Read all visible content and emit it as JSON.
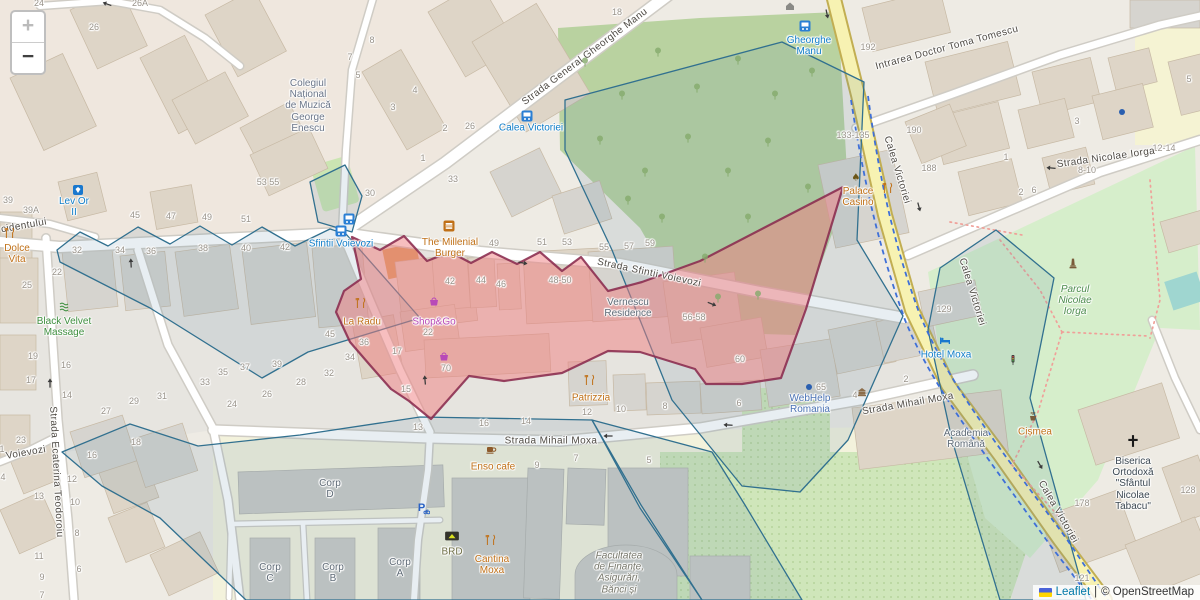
{
  "controls": {
    "zoom_in": "+",
    "zoom_out": "−"
  },
  "attribution": {
    "leaflet": "Leaflet",
    "separator": "|",
    "osm": "© OpenStreetMap"
  },
  "colors": {
    "selection_fill": "#ef7d80",
    "selection_stroke": "#8a2b4e",
    "district_stroke": "#31708f",
    "district_fill": "#5b8aa6",
    "primary_road": "#f7f2b2",
    "leaflet_link": "#0078a8",
    "park_green": "#d6eecb",
    "tree_green": "#b9d2a0",
    "campus_yellow": "#f3f2dc"
  },
  "map": {
    "street_labels": [
      [
        "Strada General Gheorghe Manu",
        585,
        57,
        -37
      ],
      [
        "Strada Sfintii Voievozi",
        649,
        273,
        12
      ],
      [
        "Strada Mihail Moxa",
        551,
        441,
        0
      ],
      [
        "Strada Mihail Moxa",
        908,
        404,
        -10
      ],
      [
        "Strada Nicolae Iorga",
        1106,
        158,
        -8
      ],
      [
        "Intrarea Doctor Toma Tomescu",
        947,
        48,
        -15
      ],
      [
        "Calea Victoriei",
        897,
        170,
        73
      ],
      [
        "Calea Victoriei",
        972,
        292,
        73
      ],
      [
        "Calea Victoriei",
        1058,
        512,
        60
      ],
      [
        "cidentului",
        24,
        226,
        -10
      ],
      [
        "Voievozi",
        26,
        453,
        -10
      ],
      [
        "Strada Ecaterina Teodoroiu",
        56,
        472,
        87
      ]
    ],
    "pois": [
      [
        "Colegiul\nNațional\nde Muzică\nGeorge\nEnescu",
        308,
        106,
        "school"
      ],
      [
        "Lev Or\nII",
        74,
        207,
        "blue"
      ],
      [
        "Dolce\nVita",
        17,
        254,
        "food"
      ],
      [
        "Black Velvet\nMassage",
        64,
        327,
        "green"
      ],
      [
        "Sfintii Voievozi",
        341,
        244,
        "blue"
      ],
      [
        "Calea Victoriei",
        531,
        128,
        "blue"
      ],
      [
        "Gheorghe\nManu",
        809,
        46,
        "blue"
      ],
      [
        "The Millenial\nBurger",
        450,
        248,
        "food"
      ],
      [
        "La Radu",
        362,
        322,
        "food"
      ],
      [
        "Shop&Go",
        434,
        322,
        "shop"
      ],
      [
        "Vernescu\nResidence",
        628,
        308,
        "muted"
      ],
      [
        "Palace\nCasino",
        858,
        197,
        "food"
      ],
      [
        "Patrizzia",
        591,
        398,
        "food"
      ],
      [
        "WebHelp\nRomania",
        810,
        404,
        "office"
      ],
      [
        "Hotel Moxa",
        946,
        355,
        "blue"
      ],
      [
        "Academia\nRomână",
        966,
        439,
        "muted"
      ],
      [
        "Cișmea",
        1035,
        432,
        "food"
      ],
      [
        "Biserica\nOrtodoxă\n\"Sfântul\nNicolae\nTabacu\"",
        1133,
        484,
        "church"
      ],
      [
        "Parcul\nNicolae\nIorga",
        1075,
        301,
        "park"
      ],
      [
        "Enso cafe",
        493,
        467,
        "food"
      ],
      [
        "BRD",
        452,
        552,
        "bank"
      ],
      [
        "Cantina\nMoxa",
        492,
        565,
        "food"
      ],
      [
        "Corp\nD",
        330,
        489,
        "muted"
      ],
      [
        "Corp\nC",
        270,
        573,
        "muted"
      ],
      [
        "Corp\nB",
        333,
        573,
        "muted"
      ],
      [
        "Corp\nA",
        400,
        568,
        "muted"
      ],
      [
        "Facultatea\nde Finanțe,\nAsigurări,\nBănci și",
        619,
        573,
        "mutedi"
      ]
    ],
    "house_numbers": [
      [
        "24",
        39,
        3
      ],
      [
        "26",
        94,
        27
      ],
      [
        "26A",
        140,
        3
      ],
      [
        "8",
        372,
        40
      ],
      [
        "7",
        350,
        57
      ],
      [
        "5",
        358,
        75
      ],
      [
        "3",
        393,
        107
      ],
      [
        "18",
        617,
        12
      ],
      [
        "4",
        415,
        90
      ],
      [
        "2",
        445,
        128
      ],
      [
        "26",
        470,
        126
      ],
      [
        "1",
        423,
        158
      ],
      [
        "33",
        453,
        179
      ],
      [
        "30",
        370,
        193
      ],
      [
        "53 55",
        268,
        182
      ],
      [
        "39",
        8,
        200
      ],
      [
        "39A",
        31,
        210
      ],
      [
        "45",
        135,
        215
      ],
      [
        "47",
        171,
        216
      ],
      [
        "49",
        207,
        217
      ],
      [
        "51",
        246,
        219
      ],
      [
        "32",
        77,
        250
      ],
      [
        "34",
        120,
        250
      ],
      [
        "36",
        151,
        251
      ],
      [
        "38",
        203,
        248
      ],
      [
        "40",
        246,
        248
      ],
      [
        "42",
        285,
        247
      ],
      [
        "22",
        57,
        272
      ],
      [
        "25",
        27,
        285
      ],
      [
        "19",
        33,
        356
      ],
      [
        "16",
        66,
        365
      ],
      [
        "17",
        31,
        380
      ],
      [
        "14",
        67,
        395
      ],
      [
        "49",
        494,
        243
      ],
      [
        "51",
        542,
        242
      ],
      [
        "53",
        567,
        242
      ],
      [
        "55",
        604,
        247
      ],
      [
        "57",
        629,
        246
      ],
      [
        "59",
        650,
        243
      ],
      [
        "42",
        450,
        281
      ],
      [
        "44",
        481,
        280
      ],
      [
        "46",
        501,
        284
      ],
      [
        "48-50",
        560,
        280
      ],
      [
        "56-58",
        694,
        317
      ],
      [
        "60",
        740,
        359
      ],
      [
        "36",
        364,
        342
      ],
      [
        "34",
        350,
        357
      ],
      [
        "22",
        428,
        332
      ],
      [
        "17",
        397,
        351
      ],
      [
        "15",
        406,
        389
      ],
      [
        "70",
        446,
        368
      ],
      [
        "13",
        418,
        427
      ],
      [
        "16",
        484,
        423
      ],
      [
        "14",
        526,
        421
      ],
      [
        "45",
        330,
        334
      ],
      [
        "39",
        277,
        364
      ],
      [
        "37",
        245,
        367
      ],
      [
        "35",
        223,
        372
      ],
      [
        "33",
        205,
        382
      ],
      [
        "31",
        162,
        396
      ],
      [
        "29",
        134,
        401
      ],
      [
        "27",
        106,
        411
      ],
      [
        "24",
        232,
        404
      ],
      [
        "26",
        267,
        394
      ],
      [
        "28",
        301,
        382
      ],
      [
        "32",
        329,
        373
      ],
      [
        "23",
        21,
        440
      ],
      [
        "1",
        2,
        449
      ],
      [
        "4",
        3,
        477
      ],
      [
        "16",
        92,
        455
      ],
      [
        "18",
        136,
        442
      ],
      [
        "12",
        72,
        479
      ],
      [
        "13",
        39,
        496
      ],
      [
        "10",
        75,
        502
      ],
      [
        "8",
        77,
        533
      ],
      [
        "11",
        39,
        556
      ],
      [
        "6",
        79,
        569
      ],
      [
        "9",
        42,
        577
      ],
      [
        "7",
        42,
        595
      ],
      [
        "9",
        537,
        465
      ],
      [
        "7",
        576,
        458
      ],
      [
        "5",
        649,
        460
      ],
      [
        "12",
        587,
        412
      ],
      [
        "10",
        621,
        409
      ],
      [
        "8",
        665,
        406
      ],
      [
        "6",
        739,
        403
      ],
      [
        "4",
        855,
        395
      ],
      [
        "2",
        906,
        379
      ],
      [
        "192",
        868,
        47
      ],
      [
        "190",
        914,
        130
      ],
      [
        "188",
        929,
        168
      ],
      [
        "133-135",
        853,
        135
      ],
      [
        "1",
        1006,
        157
      ],
      [
        "3",
        1077,
        121
      ],
      [
        "5",
        1189,
        79
      ],
      [
        "2",
        1021,
        192
      ],
      [
        "6",
        1034,
        190
      ],
      [
        "8-10",
        1087,
        170
      ],
      [
        "12-14",
        1164,
        148
      ],
      [
        "129",
        944,
        309
      ],
      [
        "65",
        821,
        387
      ],
      [
        "178",
        1082,
        503
      ],
      [
        "121",
        1082,
        578
      ],
      [
        "128",
        1188,
        490
      ]
    ],
    "icons": [
      [
        "bus",
        349,
        219
      ],
      [
        "bus",
        341,
        231
      ],
      [
        "bus",
        527,
        116
      ],
      [
        "bus",
        805,
        26
      ],
      [
        "gem",
        78,
        190
      ],
      [
        "fork",
        10,
        233
      ],
      [
        "fork",
        361,
        303
      ],
      [
        "fork",
        590,
        380
      ],
      [
        "fork",
        491,
        540
      ],
      [
        "fork",
        888,
        188
      ],
      [
        "casino",
        856,
        177
      ],
      [
        "burger",
        449,
        226
      ],
      [
        "cup",
        491,
        450
      ],
      [
        "basket",
        434,
        301
      ],
      [
        "basket",
        444,
        356
      ],
      [
        "massage",
        64,
        306
      ],
      [
        "bed",
        945,
        340
      ],
      [
        "dot",
        809,
        387
      ],
      [
        "dot",
        1122,
        112
      ],
      [
        "cross",
        1133,
        441,
        14
      ],
      [
        "monument",
        1073,
        264,
        13
      ],
      [
        "fountain",
        1033,
        416
      ],
      [
        "brd",
        452,
        536,
        15
      ],
      [
        "home",
        790,
        6
      ],
      [
        "museum",
        862,
        392
      ],
      [
        "parking",
        423,
        508,
        14
      ],
      [
        "traffic",
        1013,
        360,
        11
      ]
    ],
    "arrows": [
      [
        131,
        263,
        -93
      ],
      [
        50,
        383,
        -90
      ],
      [
        608,
        436,
        180
      ],
      [
        728,
        425,
        183
      ],
      [
        1051,
        168,
        185
      ],
      [
        827,
        14,
        78
      ],
      [
        919,
        207,
        75
      ],
      [
        1040,
        465,
        60
      ],
      [
        425,
        380,
        -95
      ],
      [
        107,
        4,
        200
      ],
      [
        523,
        263,
        10
      ],
      [
        712,
        304,
        22
      ]
    ],
    "trees": [
      [
        585,
        62
      ],
      [
        622,
        95
      ],
      [
        658,
        52
      ],
      [
        697,
        88
      ],
      [
        738,
        60
      ],
      [
        775,
        95
      ],
      [
        812,
        72
      ],
      [
        600,
        140
      ],
      [
        645,
        172
      ],
      [
        688,
        138
      ],
      [
        728,
        172
      ],
      [
        768,
        142
      ],
      [
        808,
        188
      ],
      [
        748,
        218
      ],
      [
        705,
        258
      ],
      [
        662,
        218
      ],
      [
        628,
        200
      ],
      [
        758,
        295
      ],
      [
        718,
        298
      ]
    ]
  }
}
